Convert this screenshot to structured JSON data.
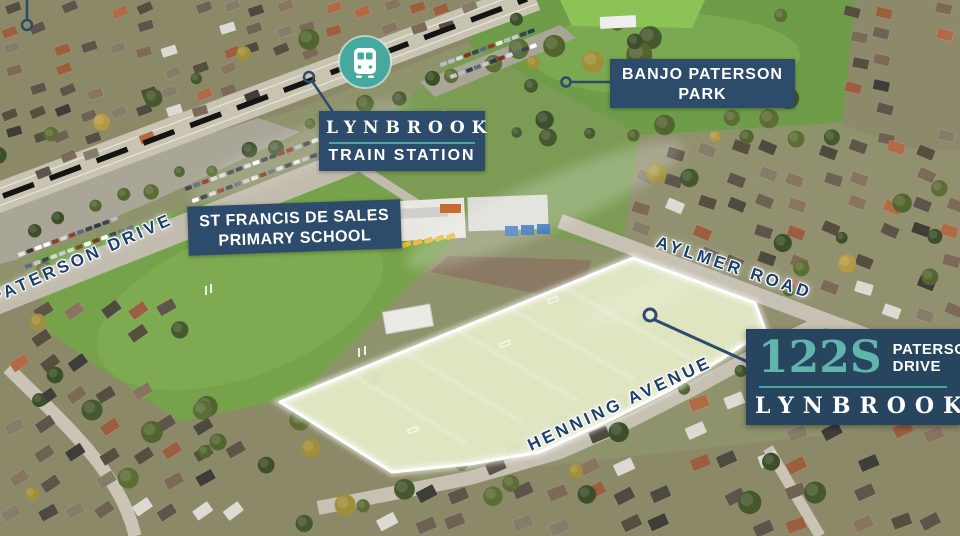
{
  "scene": {
    "description": "Aerial site map of development land at 122S Paterson Drive, Lynbrook",
    "highlighted_site": "122S Paterson Drive"
  },
  "colors": {
    "navy": "#2d4b6b",
    "navyDark": "#27455f",
    "teal": "#47a89f",
    "tealLight": "#63b4ac",
    "roadText": "#1d3f6b",
    "boundary": "#ffffff",
    "railway": "#141414",
    "fieldHighlight": "#e4e9c6"
  },
  "labels": {
    "train_station": {
      "line1": "LYNBROOK",
      "line2": "TRAIN STATION"
    },
    "park": {
      "line1": "BANJO PATERSON",
      "line2": "PARK"
    },
    "school": {
      "line1": "ST FRANCIS DE SALES",
      "line2": "PRIMARY SCHOOL"
    },
    "roads": {
      "paterson": "PATERSON DRIVE",
      "aylmer": "AYLMER ROAD",
      "henning": "HENNING AVENUE"
    }
  },
  "badge": {
    "lot": "122S",
    "street_line1": "PATERSON",
    "street_line2": "DRIVE",
    "suburb": "LYNBROOK"
  },
  "icons": {
    "train": "train-icon"
  }
}
